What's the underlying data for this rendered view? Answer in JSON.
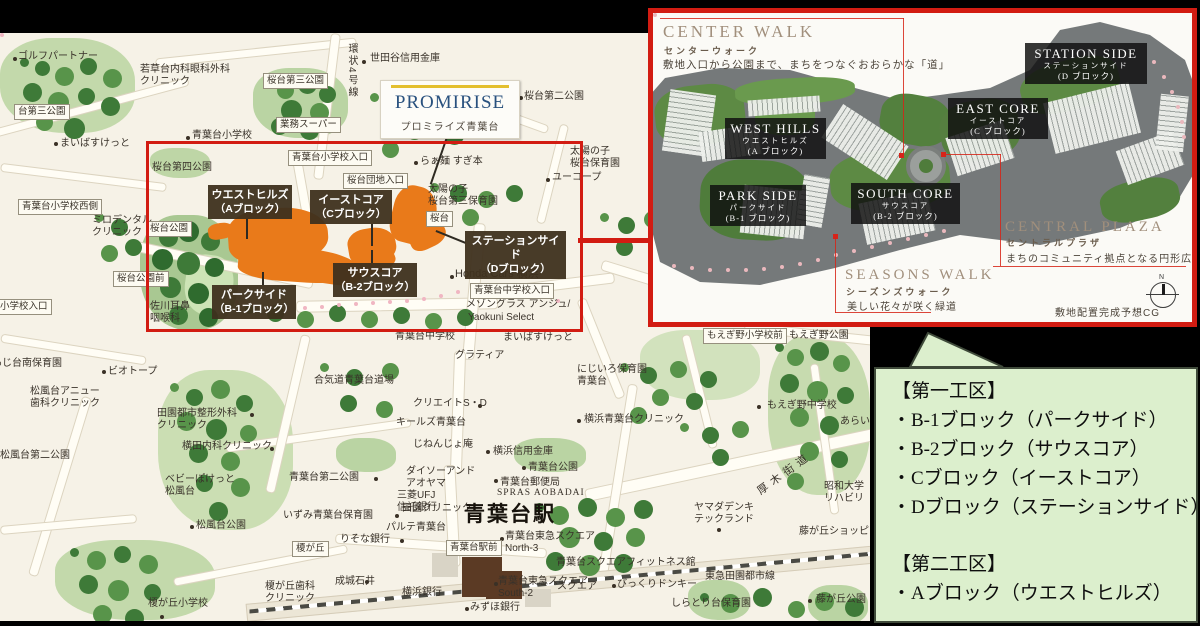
{
  "logo": {
    "title": "PROMIRISE",
    "subtitle": "プロミライズ青葉台"
  },
  "site_blocks": [
    {
      "name": "ウエストヒルズ",
      "block": "（Aブロック）"
    },
    {
      "name": "イーストコア",
      "block": "（Cブロック）"
    },
    {
      "name": "ステーションサイド",
      "block": "（Dブロック）"
    },
    {
      "name": "サウスコア",
      "block": "（B-2ブロック）"
    },
    {
      "name": "パークサイド",
      "block": "（B-1ブロック）"
    }
  ],
  "map": {
    "station": "青葉台駅",
    "vertical_road": "環状4号線",
    "diagonal_road": "厚木街道",
    "boxed": [
      "台第三公園",
      "桜台第三公園",
      "業務スーパー",
      "青葉台小学校入口",
      "桜台団地入口",
      "青葉台小学校西側",
      "桜台",
      "桜台公園",
      "桜台公園前",
      "小学校入口",
      "青葉台中学校入口",
      "榎が丘",
      "青葉台駅前",
      "もえぎ野小学校前"
    ],
    "pois": [
      "ゴルフパートナー",
      "若草台内科眼科外科\nクリニック",
      "世田谷信用金庫",
      "青葉台小学校",
      "まいばすけっと",
      "ミロデンタル\nクリニック",
      "桜台第四公園",
      "らぁ麺 すぎ本",
      "太陽の子\n桜台第三保育園",
      "ユーコープ",
      "太陽の子\n桜台保育園",
      "桜台第二公園",
      "佐川耳鼻\n咽喉科",
      "Honda Cars 横浜",
      "メゾングラス アンジュ/",
      "Yaokuni Select",
      "あじ台南保育園",
      "ビオトープ",
      "松風台アニュー\n歯科クリニック",
      "田園都市整形外科\nクリニック",
      "横田内科クリニック",
      "松風台第二公園",
      "ベビーぽけっと\n松風台",
      "松風台公園",
      "合気道青葉台道場",
      "青葉台第二公園",
      "クリエイトS・D",
      "キールズ青葉台",
      "じねんじょ庵",
      "ダイソーアンド\nアオヤマ",
      "田園クリニック",
      "横浜信用金庫",
      "青葉台公園",
      "青葉台郵便局",
      "SPRAS AOBADAI",
      "三菱UFJ\n信託銀行",
      "いずみ青葉台保育園",
      "パルテ青葉台",
      "りそな銀行",
      "成城石井",
      "横浜銀行",
      "青葉台東急スクエア\nNorth-3",
      "青葉台東急スクエア\nSouth-2",
      "みずほ銀行",
      "榎が丘歯科\nクリニック",
      "榎が丘小学校",
      "にじいろ保育園\n青葉台",
      "横浜青葉台クリニック",
      "もえぎ野中学校",
      "あらい",
      "ヤマダデンキ\nテックランド",
      "昭和大学\nリハビリ",
      "藤が丘ショッピ",
      "青葉台スクエアフィットネス館",
      "びっくりドンキー",
      "東急田園都市線",
      "しらとり台保育園",
      "藤が丘公園",
      "もえぎ野公園",
      "スクエア",
      "グラティア",
      "青葉台中学校",
      "まいばすけっと"
    ]
  },
  "inset": {
    "areas": [
      {
        "en": "CENTER WALK",
        "jp": "センターウォーク",
        "desc": "敷地入口から公園まで、まちをつなぐおおらかな「道」"
      },
      {
        "en": "CENTRAL PLAZA",
        "jp": "セントラルプラザ",
        "desc": "まちのコミュニティ拠点となる円形広場"
      },
      {
        "en": "SEASONS WALK",
        "jp": "シーズンズウォーク",
        "desc": "美しい花々が咲く緑道"
      }
    ],
    "blocks": [
      {
        "en": "WEST HILLS",
        "jp": "ウエストヒルズ",
        "block": "(A ブロック)"
      },
      {
        "en": "EAST CORE",
        "jp": "イーストコア",
        "block": "(C ブロック)"
      },
      {
        "en": "STATION SIDE",
        "jp": "ステーションサイド",
        "block": "(D ブロック)"
      },
      {
        "en": "PARK SIDE",
        "jp": "パークサイド",
        "block": "(B-1 ブロック)"
      },
      {
        "en": "SOUTH CORE",
        "jp": "サウスコア",
        "block": "(B-2 ブロック)"
      }
    ],
    "caption": "敷地配置完成予想CG",
    "compass": "N"
  },
  "info_box": {
    "section1": {
      "title": "【第一工区】",
      "items": [
        "・B-1ブロック（パークサイド）",
        "・B-2ブロック（サウスコア）",
        "・Cブロック（イーストコア）",
        "・Dブロック（ステーションサイド）"
      ]
    },
    "section2": {
      "title": "【第二工区】",
      "items": [
        "・Aブロック（ウエストヒルズ）"
      ]
    }
  }
}
